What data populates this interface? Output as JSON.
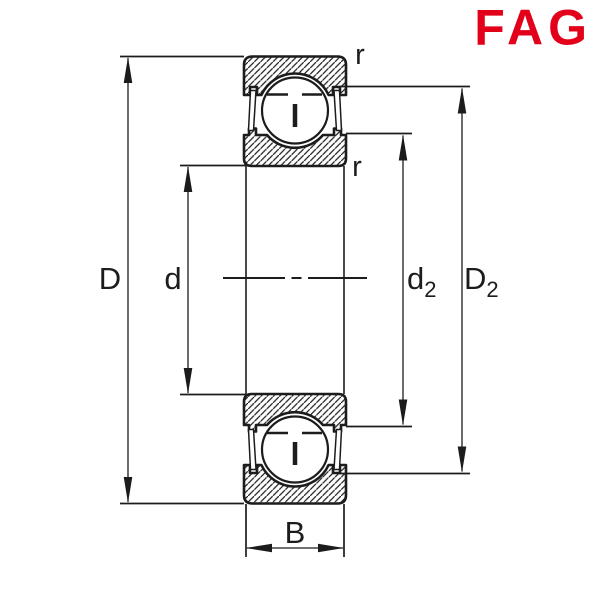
{
  "brand": {
    "logo_text": "FAG",
    "logo_color": "#E2001A"
  },
  "dimensions": {
    "outer_diameter": "D",
    "bore_diameter": "d",
    "inner_land_main": "d",
    "inner_land_sub": "2",
    "outer_recess_main": "D",
    "outer_recess_sub": "2",
    "width": "B",
    "chamfer_radius_top": "r",
    "chamfer_radius_bottom": "r"
  },
  "colors": {
    "line": "#1c1c1c",
    "background": "#ffffff",
    "logo_red": "#E2001A"
  }
}
